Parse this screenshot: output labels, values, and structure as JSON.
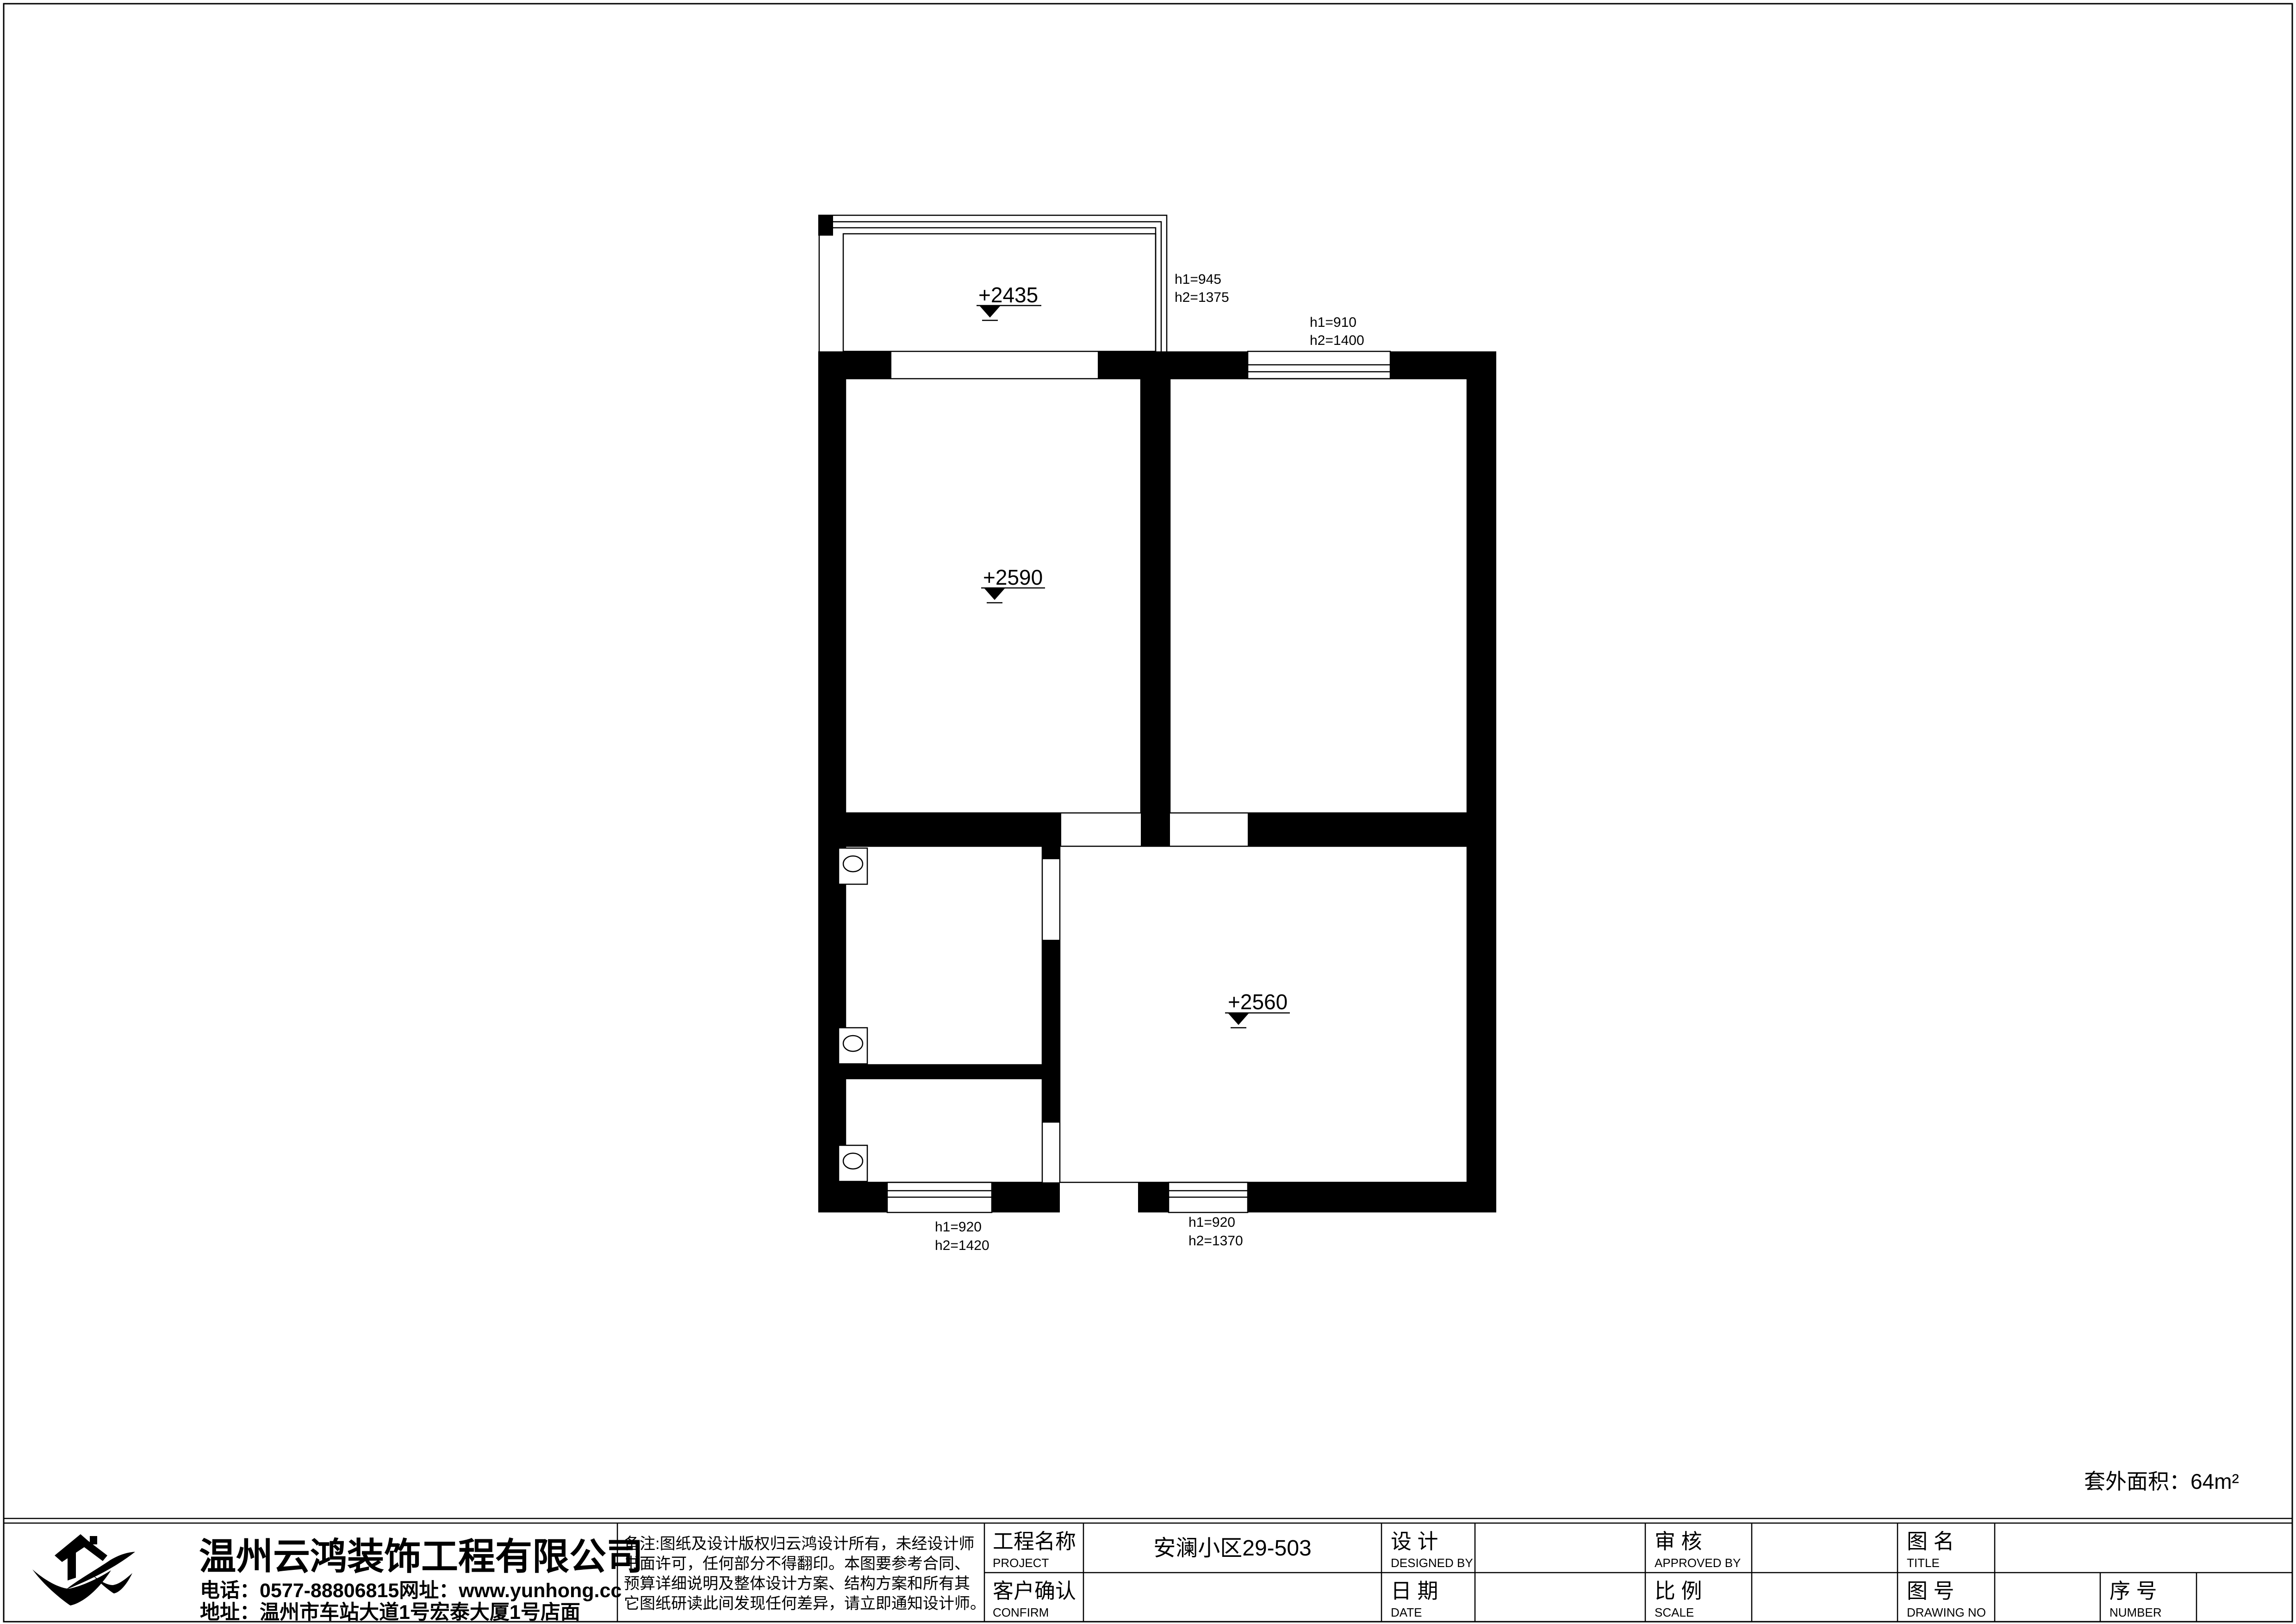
{
  "drawing": {
    "area_note": "套外面积：64m²",
    "elevations": {
      "balcony": "+2435",
      "bedroom_left": "+2590",
      "living": "+2560"
    },
    "window_annotations": {
      "balcony": [
        "h1=945",
        "h2=1375"
      ],
      "bedroom_right": [
        "h1=910",
        "h2=1400"
      ],
      "bottom_left": [
        "h1=920",
        "h2=1420"
      ],
      "bottom_right": [
        "h1=920",
        "h2=1370"
      ]
    }
  },
  "title_block": {
    "company": {
      "name": "温州云鸿装饰工程有限公司",
      "phone_line": "电话：0577-88806815网址：www.yunhong.cc",
      "address_line": "地址：温州市车站大道1号宏泰大厦1号店面"
    },
    "notes": {
      "lines": [
        "备注:图纸及设计版权归云鸿设计所有，未经设计师",
        "书面许可，任何部分不得翻印。本图要参考合同、",
        "预算详细说明及整体设计方案、结构方案和所有其",
        "它图纸研读此间发现任何差异，请立即通知设计师。"
      ]
    },
    "fields": {
      "project_label": "工程名称",
      "project_label_en": "PROJECT",
      "project_value": "安澜小区29-503",
      "confirm_label": "客户确认",
      "confirm_label_en": "CONFIRM",
      "designed_label": "设 计",
      "designed_label_en": "DESIGNED BY",
      "date_label": "日 期",
      "date_label_en": "DATE",
      "approved_label": "审 核",
      "approved_label_en": "APPROVED BY",
      "scale_label": "比 例",
      "scale_label_en": "SCALE",
      "title_label": "图 名",
      "title_label_en": "TITLE",
      "drawingno_label": "图 号",
      "drawingno_label_en": "DRAWING NO",
      "number_label": "序 号",
      "number_label_en": "NUMBER"
    }
  }
}
